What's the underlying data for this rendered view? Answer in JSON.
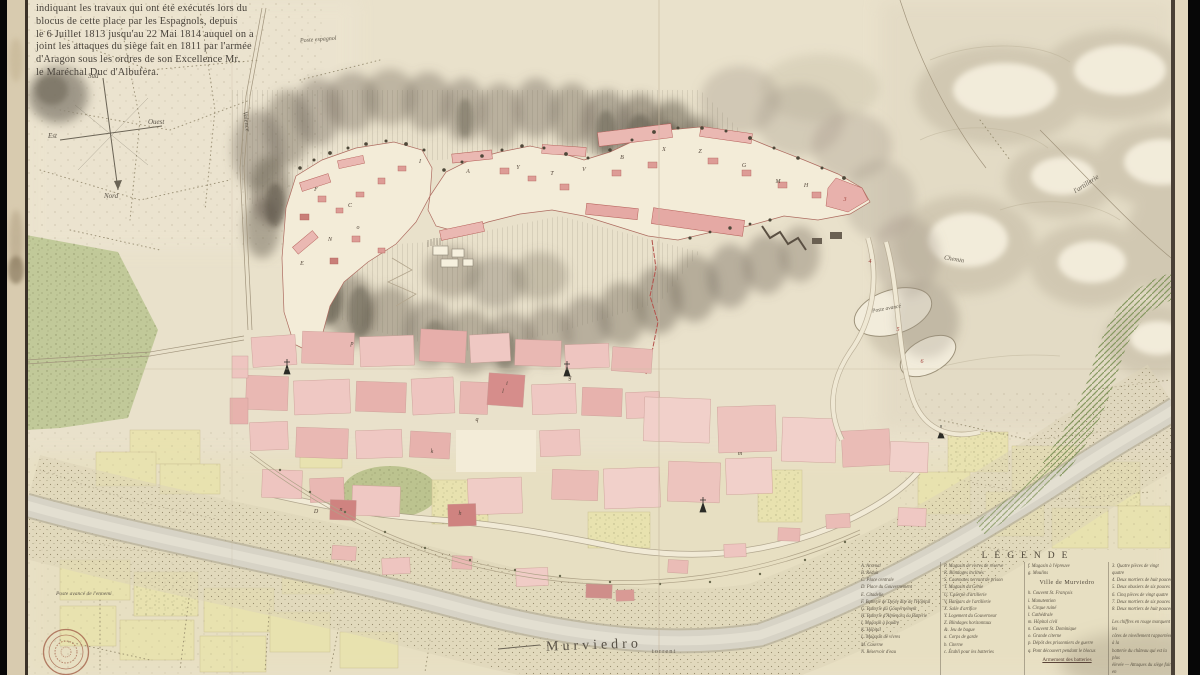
{
  "map_title": {
    "lines": [
      "indiquant les travaux qui ont été exécutés lors du",
      "blocus de cette place par les Espagnols, depuis",
      "le 6 Juillet 1813 jusqu'au 22 Mai 1814 auquel on a",
      "joint les attaques du siège fait en 1811 par l'armée",
      "d'Aragon sous les ordres de son Excellence Mr.",
      "le Maréchal Duc d'Albufera."
    ]
  },
  "compass": {
    "south": "Sud",
    "west": "Ouest",
    "east": "Est",
    "north": "Nord"
  },
  "labels": {
    "poste_espagnol": "Poste espagnol",
    "valence": "Valence",
    "artillerie": "l'artillerie",
    "chemin": "Chemin",
    "poste_avance": "Poste avancé",
    "poste_avance_ennemi": "Poste avancé de l'ennemi",
    "river_name": "Murviedro",
    "river_type": "torrent"
  },
  "legend": {
    "heading": "LÉGENDE",
    "col1": [
      "A. Arsenal",
      "B. Réduit",
      "C. Place centrale",
      "D. Place du Gouvernement",
      "E. Citadelle",
      "F. Batterie de Doyle dite de l'Hôpital",
      "G. Batterie du Gouvernement",
      "H. Batterie d'Almenara ou Batterie",
      "I. Magasin à poudre",
      "K. Hôpital",
      "L. Magasin de vivres",
      "M. Caserne",
      "N. Réservoir d'eau"
    ],
    "col2": [
      "P. Magasin de vivres de réserve",
      "R. Blindages inclinés",
      "S. Casemates servant de prison",
      "T. Magasin du Génie",
      "U. Caserne d'artillerie",
      "V. Hangars de l'artillerie",
      "X. Salle d'artifice",
      "Y. Logement du Gouverneur",
      "Z. Blindages horizontaux",
      "&. Jeu de bague",
      "a. Corps de garde",
      "b. Citerne",
      "c. Établi pour les batteries"
    ],
    "col3_top": [
      "f. Magasin à l'épreuve",
      "g. Moulins"
    ],
    "col3_heading": "Ville de Murviedro",
    "col3_items": [
      "h. Couvent St. François",
      "i. Manutention",
      "k. Cirque ruiné",
      "l. Cathédrale",
      "m. Hôpital civil",
      "n. Couvent St. Dominique",
      "o. Grande citerne",
      "p. Dépôt des prisonniers de guerre",
      "q. Pont découvert pendant le blocus"
    ],
    "col3_footer": "Armement des batteries",
    "col4_items": [
      "3. Quatre pièces de vingt quatre",
      "4. Deux mortiers de huit pouces",
      "5. Deux obusiers de six pouces",
      "6. Cinq pièces de vingt quatre",
      "7. Deux mortiers de six pouces",
      "8. Deux mortiers de huit pouces"
    ],
    "col4_note": [
      "Les chiffres en rouge marquent les",
      "côtes de nivellement rapportées à la",
      "batterie du château qui est la plus",
      "élevée — Attaques du siège fait en",
      "1811 — Murviedro"
    ]
  },
  "map_letters": [
    {
      "t": "F",
      "x": 316,
      "y": 190
    },
    {
      "t": "C",
      "x": 350,
      "y": 206
    },
    {
      "t": "N",
      "x": 330,
      "y": 240
    },
    {
      "t": "E",
      "x": 302,
      "y": 264
    },
    {
      "t": "o",
      "x": 358,
      "y": 228
    },
    {
      "t": "I",
      "x": 420,
      "y": 162
    },
    {
      "t": "A",
      "x": 468,
      "y": 172
    },
    {
      "t": "Y",
      "x": 518,
      "y": 168
    },
    {
      "t": "T",
      "x": 552,
      "y": 174
    },
    {
      "t": "V",
      "x": 584,
      "y": 170
    },
    {
      "t": "B",
      "x": 622,
      "y": 158
    },
    {
      "t": "X",
      "x": 664,
      "y": 150
    },
    {
      "t": "Z",
      "x": 700,
      "y": 152
    },
    {
      "t": "G",
      "x": 744,
      "y": 166
    },
    {
      "t": "M",
      "x": 778,
      "y": 182
    },
    {
      "t": "H",
      "x": 806,
      "y": 186
    },
    {
      "t": "3",
      "x": 845,
      "y": 200,
      "c": "#a3403a"
    },
    {
      "t": "4",
      "x": 870,
      "y": 262,
      "c": "#a3403a"
    },
    {
      "t": "5",
      "x": 898,
      "y": 330,
      "c": "#a3403a"
    },
    {
      "t": "6",
      "x": 922,
      "y": 362,
      "c": "#a3403a"
    },
    {
      "t": "l",
      "x": 503,
      "y": 392
    },
    {
      "t": "q",
      "x": 477,
      "y": 420
    },
    {
      "t": "m",
      "x": 740,
      "y": 454
    },
    {
      "t": "h",
      "x": 460,
      "y": 514
    },
    {
      "t": "n",
      "x": 341,
      "y": 510
    },
    {
      "t": "D",
      "x": 316,
      "y": 512
    },
    {
      "t": "p",
      "x": 352,
      "y": 344
    },
    {
      "t": "i",
      "x": 507,
      "y": 384
    },
    {
      "t": "k",
      "x": 432,
      "y": 452
    },
    {
      "t": "g",
      "x": 570,
      "y": 378
    }
  ],
  "colors": {
    "paper": "#e9e1cb",
    "town_pink": "#e8b4af",
    "deep_red": "#cf8380",
    "wall_red": "#b5524c",
    "field_green": "#bdc793",
    "field_yellow": "#e9e3ae",
    "hachure_gray": "#6e6557",
    "ink": "#4b453c",
    "stamp_red": "#a86a52"
  }
}
